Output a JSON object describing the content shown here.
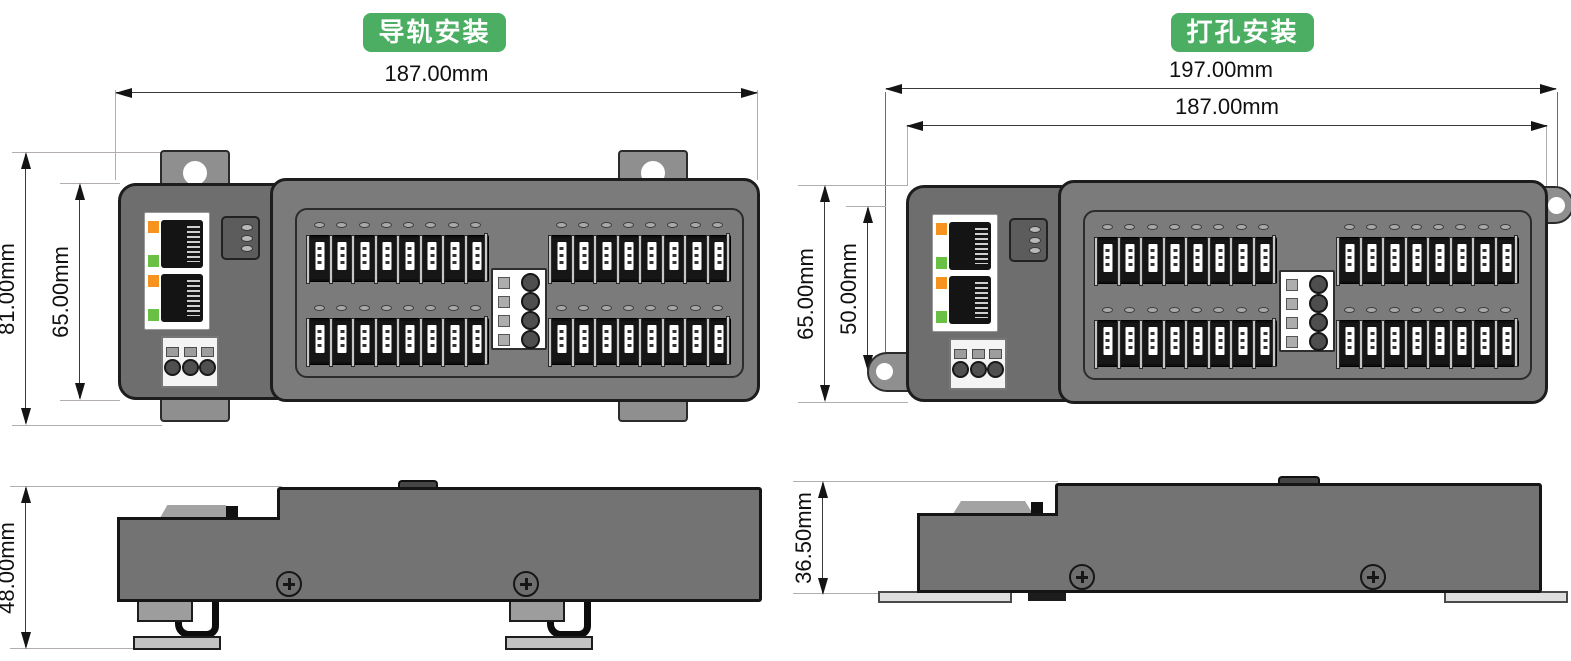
{
  "rail": {
    "badge": "导轨安装",
    "dim_width": "187.00mm",
    "dim_height_outer": "81.00mm",
    "dim_height_body": "65.00mm",
    "dim_side_height": "48.00mm"
  },
  "screw": {
    "badge": "打孔安装",
    "dim_width_outer": "197.00mm",
    "dim_width_body": "187.00mm",
    "dim_height_body": "65.00mm",
    "dim_hole_span": "50.00mm",
    "dim_side_height": "36.50mm"
  },
  "device": {
    "ethernet_ports": 2,
    "status_leds": 3,
    "power_terminals": 3,
    "io_groups": 4,
    "io_terminals_per_group": 8,
    "io_leds_per_group": 8,
    "center_connector_pins": 4
  },
  "colors": {
    "badge_green": "#4BAE63",
    "body_gray": "#7B7B7B",
    "module_gray": "#6E6E6E",
    "side_gray": "#737373",
    "tab_gray": "#8F8F8F",
    "panel_white": "#FFFFFF",
    "plate_gray": "#DEDEDE",
    "led_orange": "#F6921E",
    "led_green": "#68C044",
    "outline": "#1D1D1D",
    "dim_line": "#3A3A3A",
    "ext_line": "#B3AEAB",
    "hole_line": "#9B5A4B"
  }
}
